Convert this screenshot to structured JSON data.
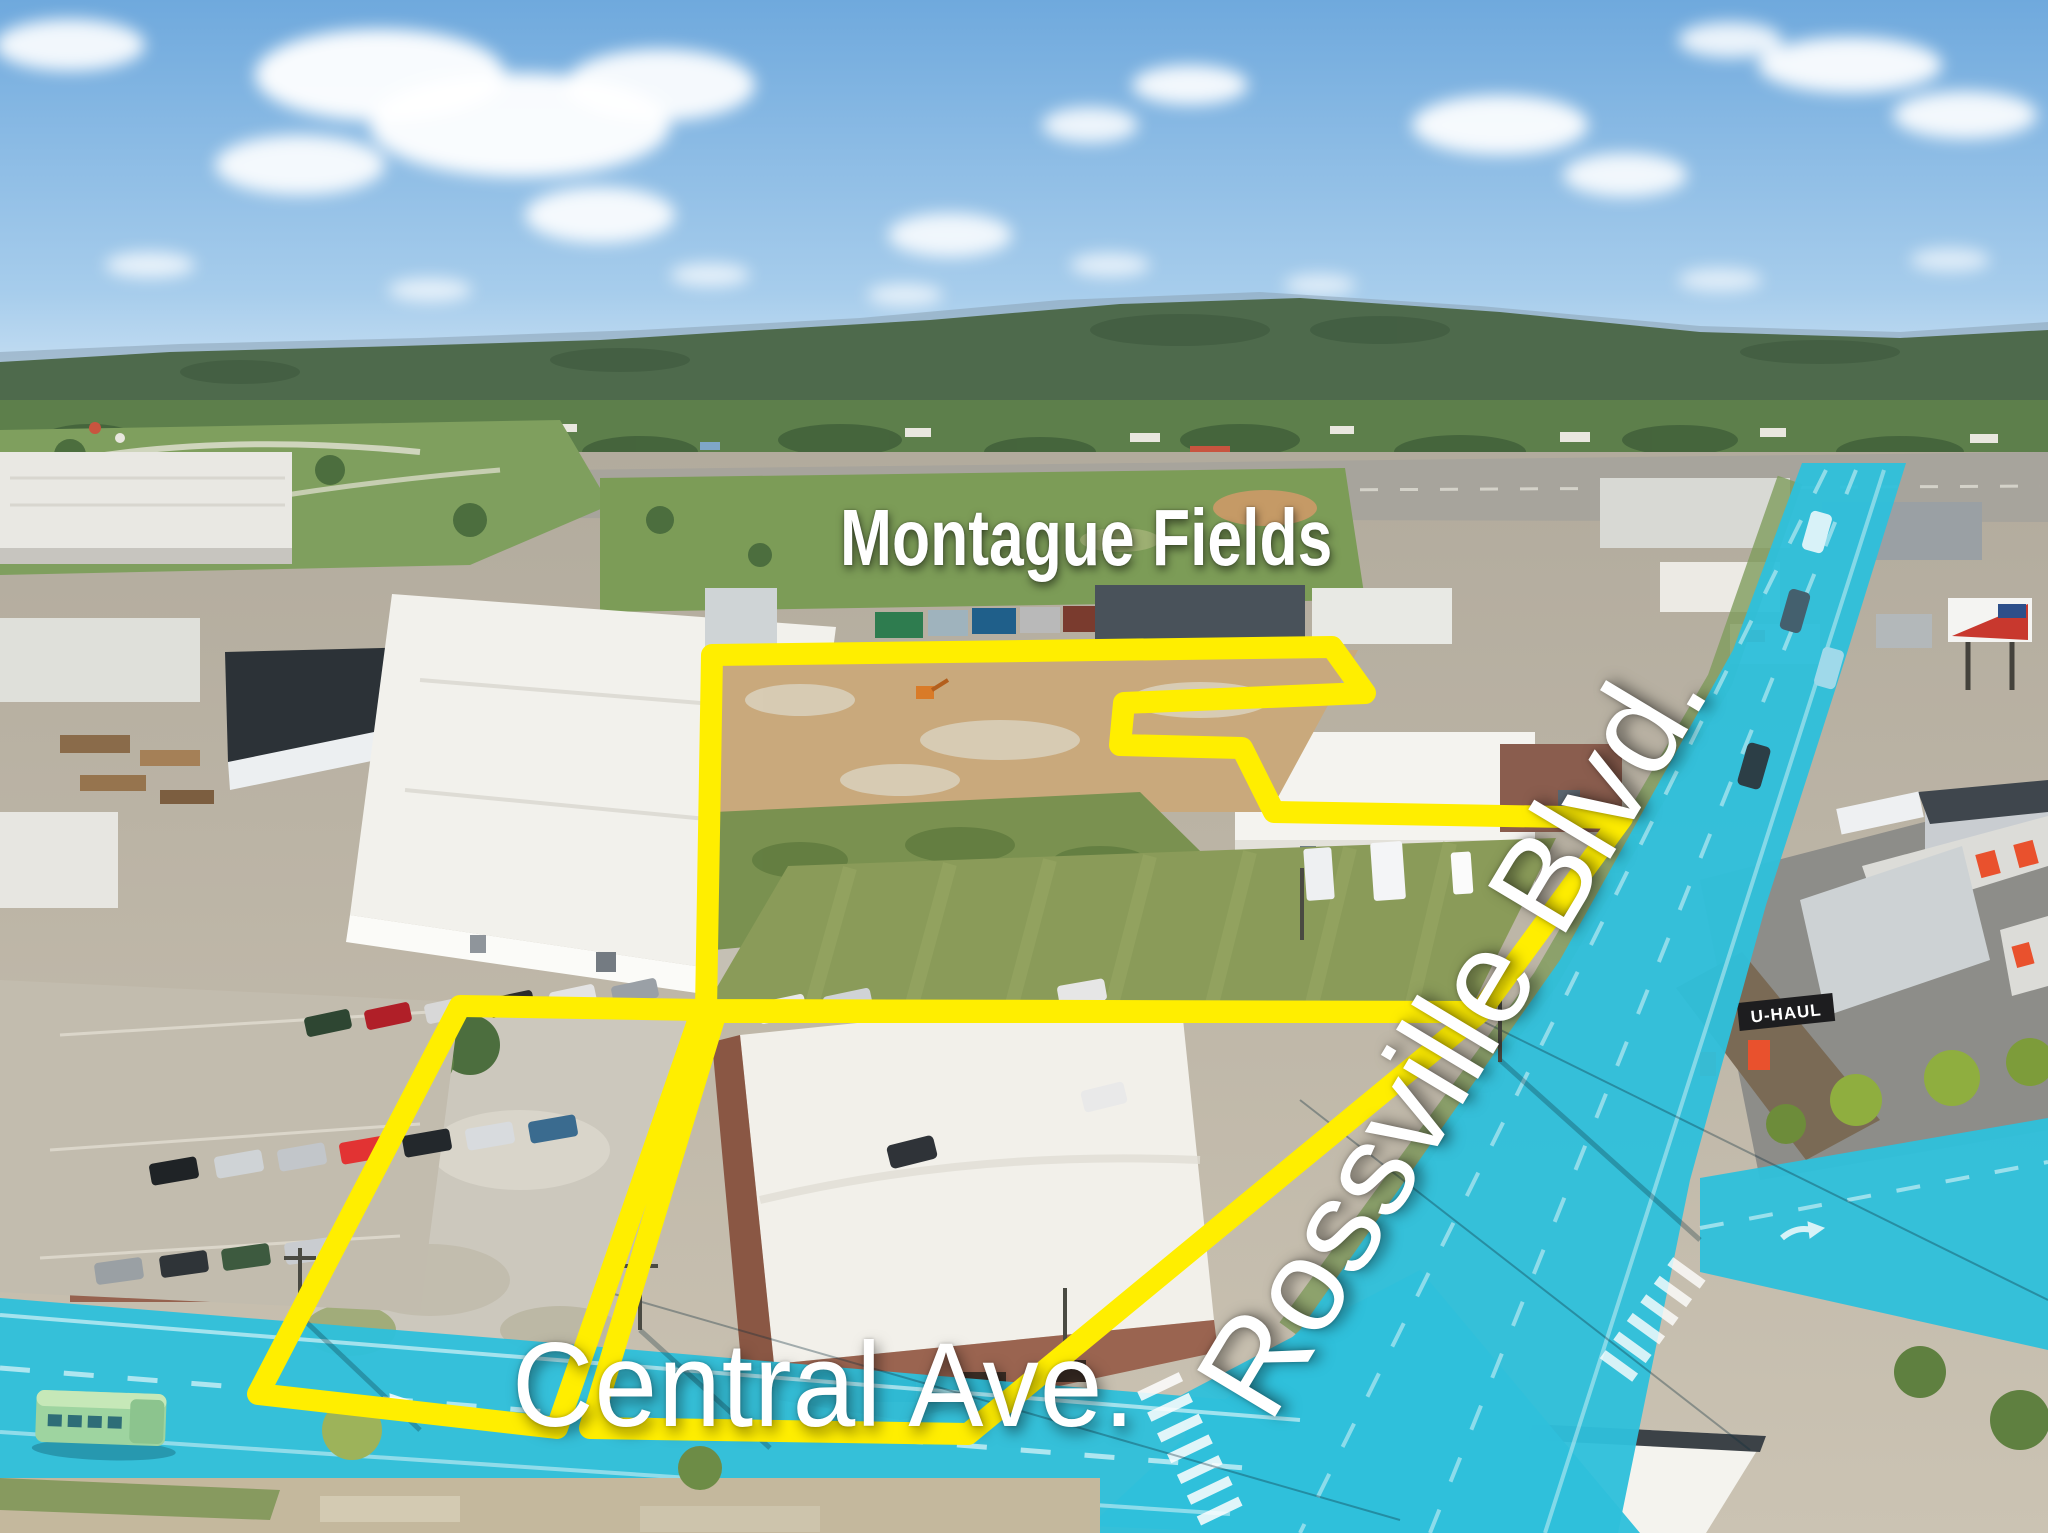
{
  "labels": {
    "property_name": "Montague Fields",
    "street_horizontal": "Central Ave.",
    "street_diagonal": "Rossville Blvd.",
    "uhaul_sign": "U-HAUL"
  },
  "colors": {
    "highlight_yellow": "#ffee00",
    "road_highlight_cyan": "#2fbfdb",
    "label_white": "#ffffff",
    "sky_top": "#79b1e3",
    "sky_horizon": "#d7e8f6",
    "hill_green": "#4e6a4c",
    "tree_green": "#5d7f4b",
    "park_green": "#7f9f5e",
    "field_green": "#8a9b59",
    "dirt_tan": "#c9a97c",
    "gravel_gray": "#c6c1b5",
    "concrete_gray": "#bdb6a8",
    "roof_white": "#f2f1ec",
    "roof_dark": "#3c4247",
    "brick_red": "#9a6450",
    "uhaul_orange": "#e9512d"
  }
}
